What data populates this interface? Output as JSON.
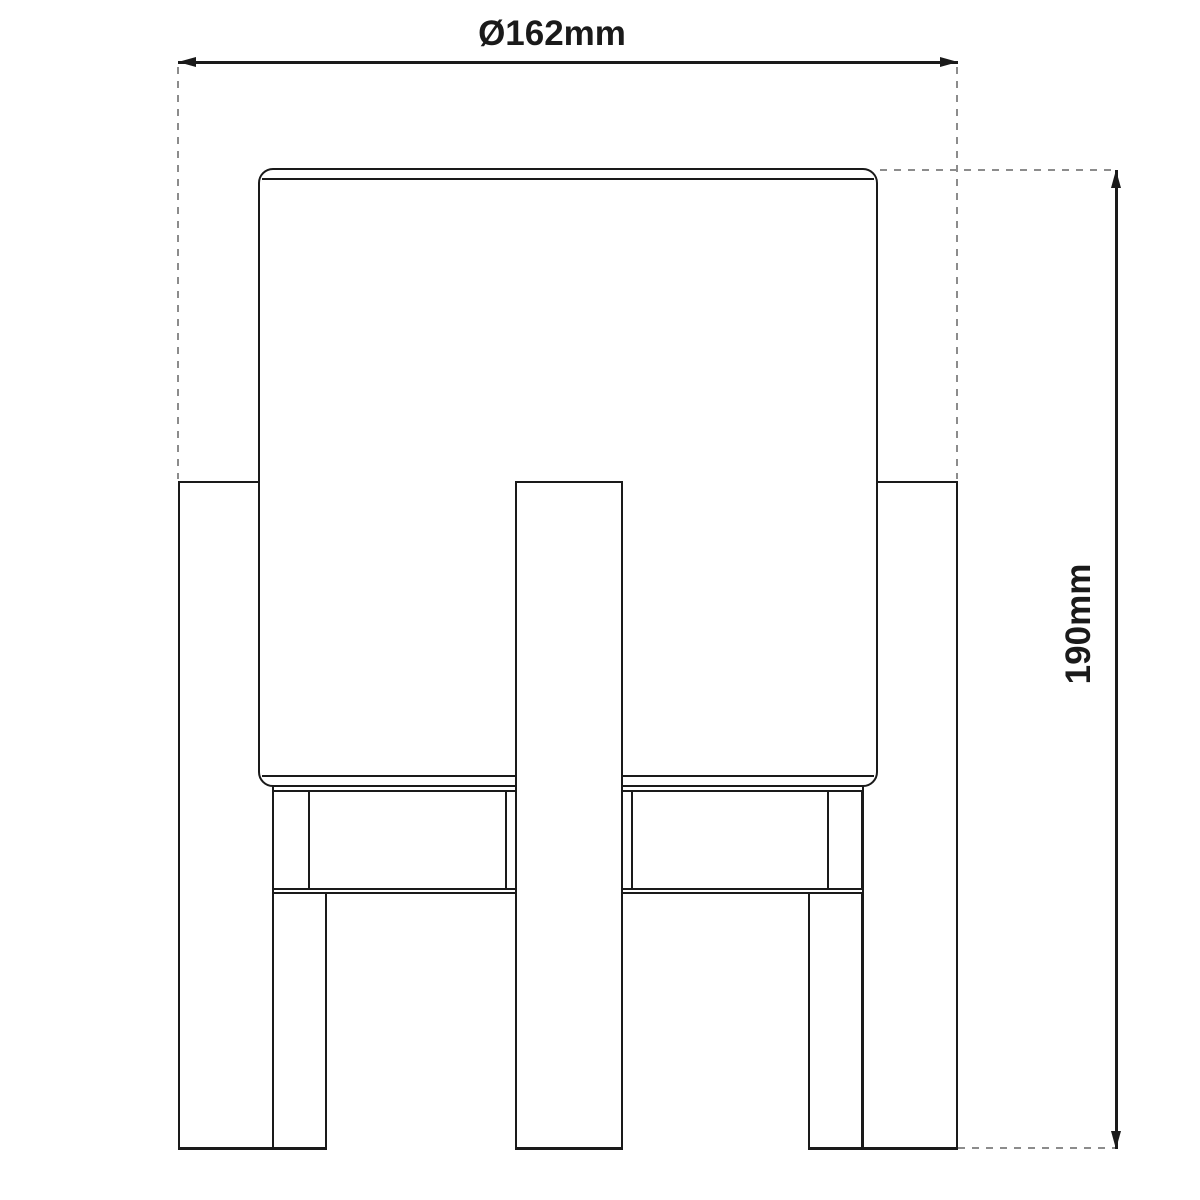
{
  "diagram": {
    "type": "technical-dimension-drawing",
    "subject": "table lamp with cylindrical shade on wooden four-leg stand, front view",
    "dimensions": {
      "diameter": {
        "label": "Ø162mm",
        "value": 162,
        "unit": "mm",
        "orientation": "horizontal"
      },
      "height": {
        "label": "190mm",
        "value": 190,
        "unit": "mm",
        "orientation": "vertical"
      }
    },
    "colors": {
      "line": "#1a1a1a",
      "extension_dashed": "#8c8c8c",
      "background": "#ffffff"
    }
  }
}
